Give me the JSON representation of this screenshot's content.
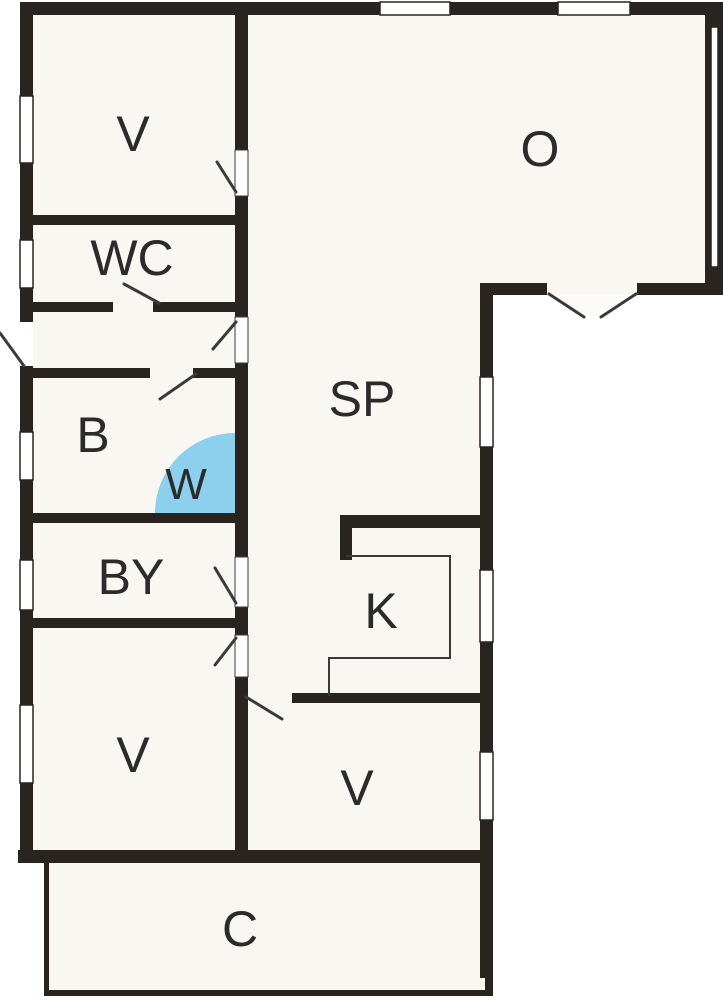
{
  "floor_plan": {
    "title": "floor-plan",
    "rooms": [
      {
        "id": "bedroom-top-left",
        "label": "V"
      },
      {
        "id": "wc",
        "label": "WC"
      },
      {
        "id": "bathroom",
        "label": "B"
      },
      {
        "id": "shower",
        "label": "W"
      },
      {
        "id": "utility-room",
        "label": "BY"
      },
      {
        "id": "bedroom-left",
        "label": "V"
      },
      {
        "id": "dining-area",
        "label": "SP"
      },
      {
        "id": "kitchen",
        "label": "K"
      },
      {
        "id": "lounge",
        "label": "O"
      },
      {
        "id": "bedroom-bottom",
        "label": "V"
      },
      {
        "id": "carport",
        "label": "C"
      }
    ],
    "colors": {
      "wall": "#2a2420",
      "room_fill": "#f8f7f2",
      "outside": "#ffffff",
      "shower_fill": "#8cd0ed",
      "line": "#3a3a3a"
    }
  }
}
